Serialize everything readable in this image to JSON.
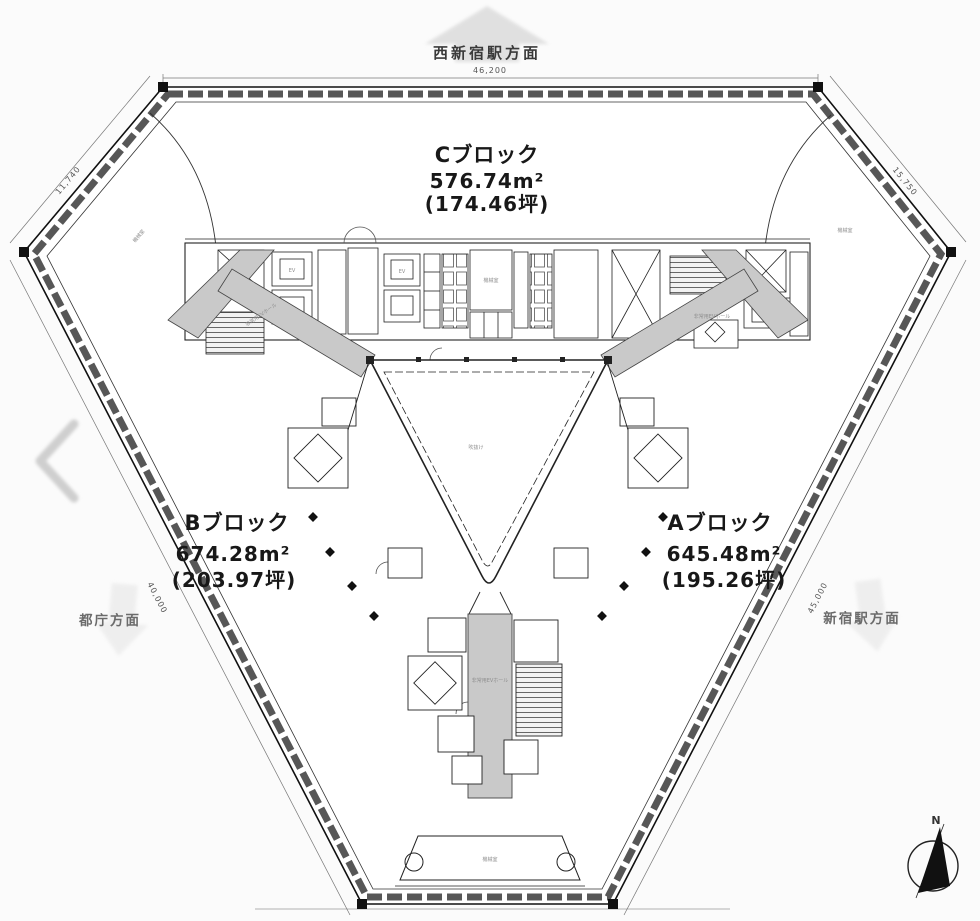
{
  "plan": {
    "directions": {
      "top": "西新宿駅方面",
      "left": "都庁方面",
      "right": "新宿駅方面"
    },
    "compass_n": "N",
    "blocks": {
      "c": {
        "name": "Cブロック",
        "m2": "576.74m²",
        "tsubo": "(174.46坪)"
      },
      "b": {
        "name": "Bブロック",
        "m2": "674.28m²",
        "tsubo": "(203.97坪)"
      },
      "a": {
        "name": "Aブロック",
        "m2": "645.48m²",
        "tsubo": "(195.26坪)"
      }
    },
    "dims": {
      "top": "46,200",
      "bottom": "19,358",
      "upper_left": "11,740",
      "upper_right": "15,750",
      "lower_left": "40,000",
      "lower_right": "45,000"
    },
    "rooms": {
      "ev": "EV",
      "machine": "機械室",
      "emergency": "非常用EVホール",
      "atrium": "吹抜け"
    },
    "colors": {
      "ink": "#1c1c1c",
      "corridor": "#c9c9c9",
      "faded_arrow": "#d8d8d8"
    }
  }
}
